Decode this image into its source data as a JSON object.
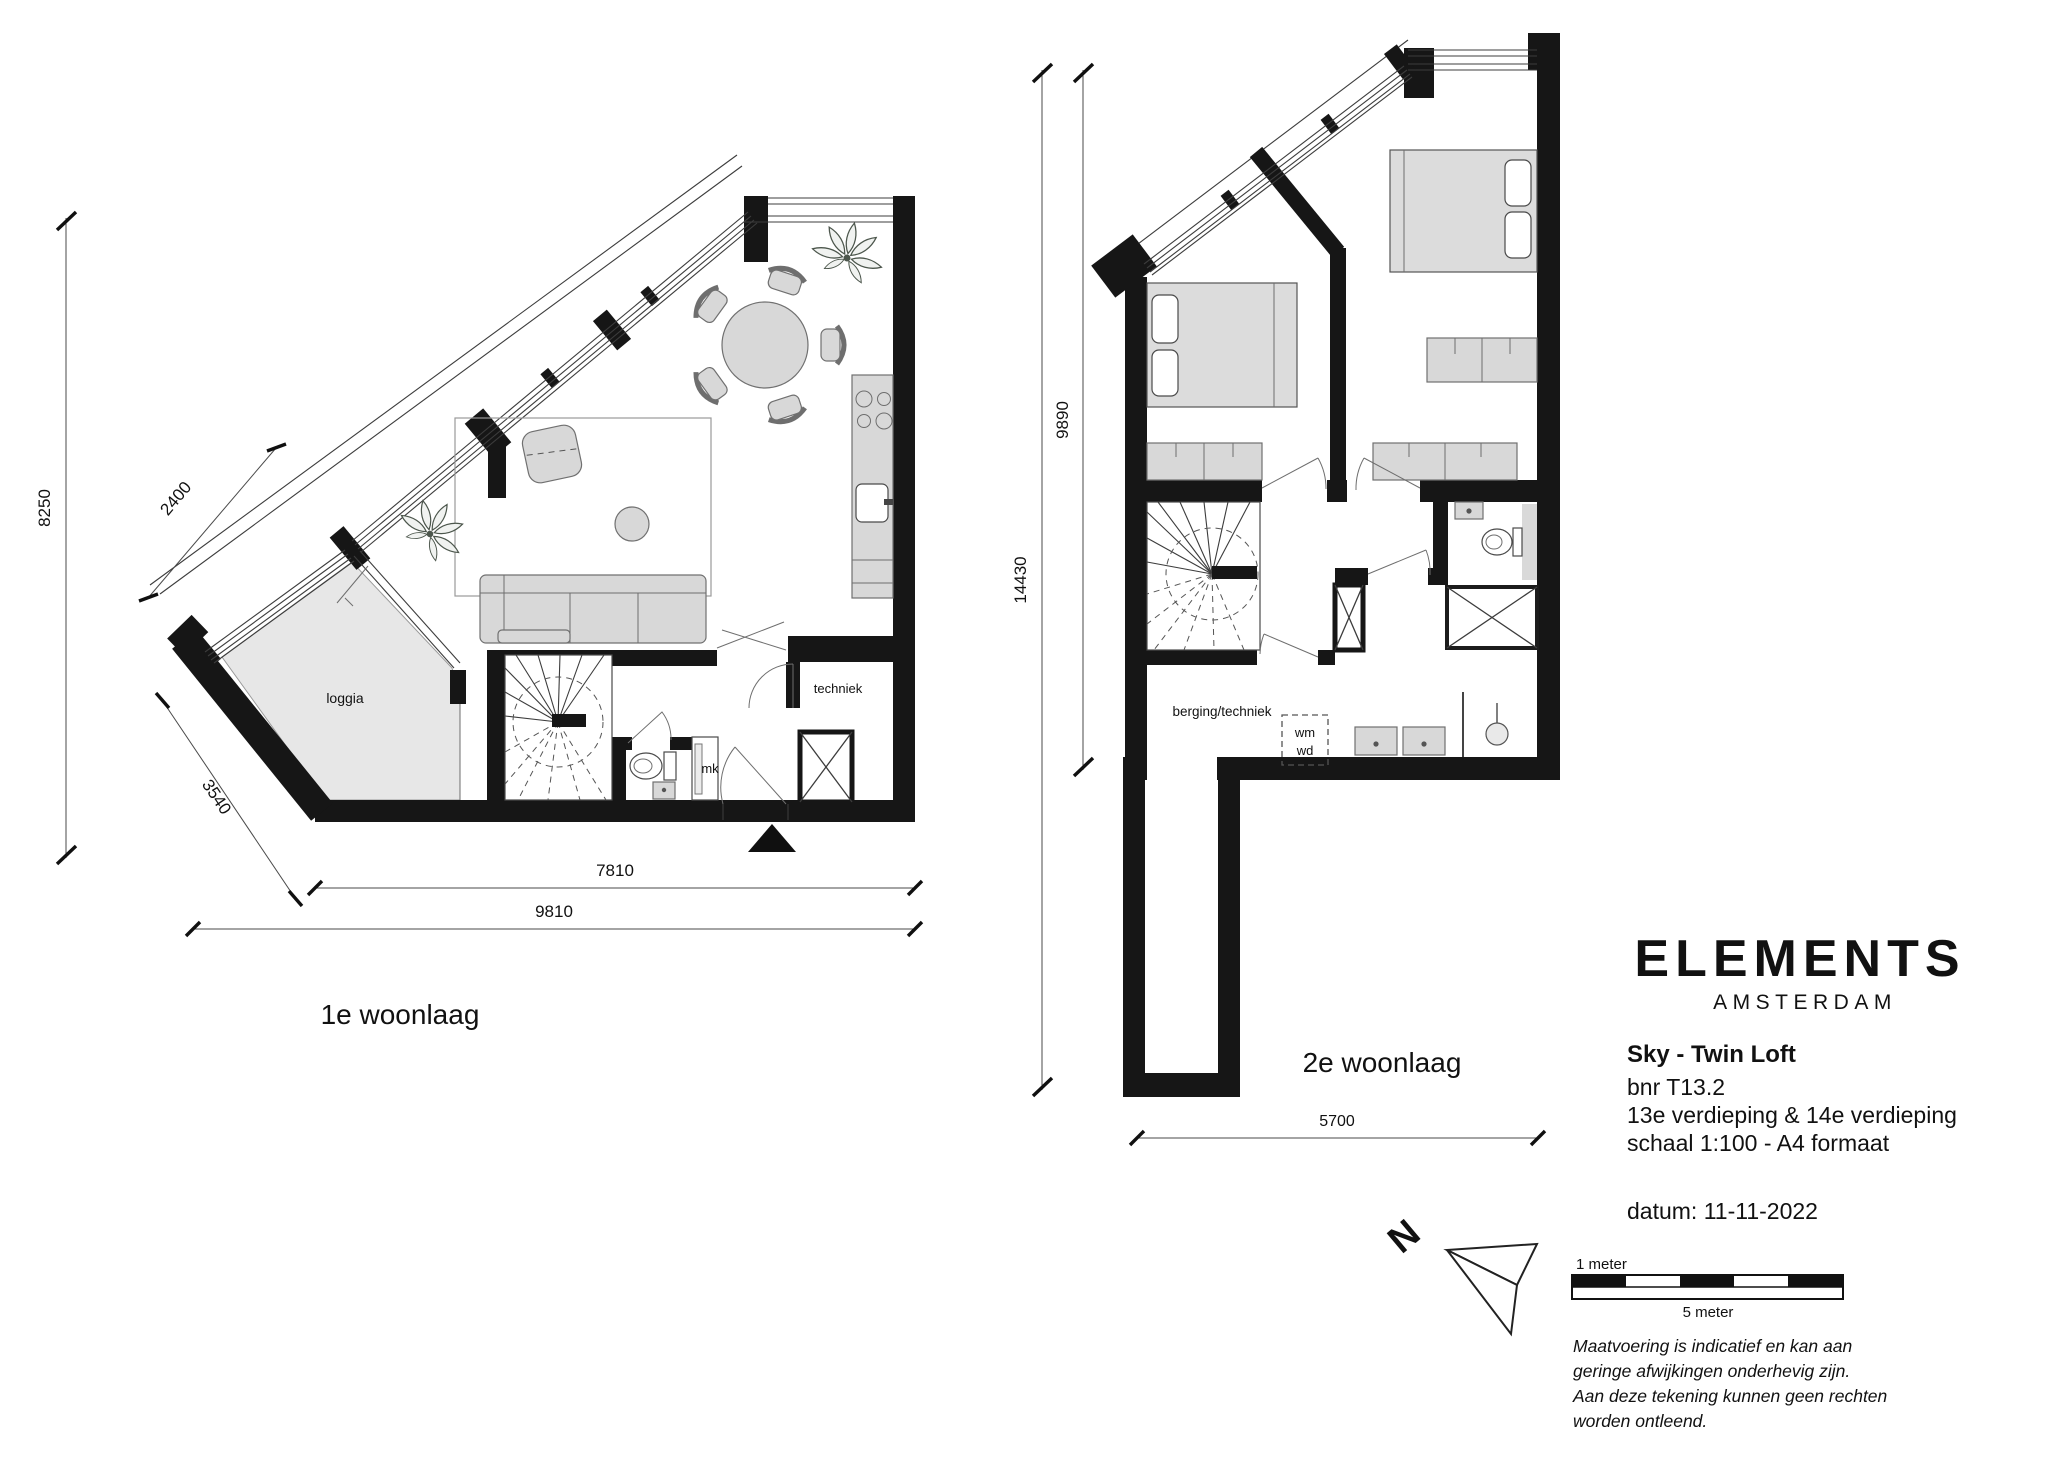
{
  "plan1": {
    "title": "1e woonlaag",
    "labels": {
      "loggia": "loggia",
      "techniek": "techniek",
      "mk": "mk"
    },
    "dims": {
      "left": "8250",
      "upper_diagonal": "2400",
      "lower_diagonal": "3540",
      "inner_width": "7810",
      "total_width": "9810"
    }
  },
  "plan2": {
    "title": "2e woonlaag",
    "labels": {
      "storage": "berging/techniek",
      "washer": "wm",
      "dryer": "wd"
    },
    "dims": {
      "upper_height": "9890",
      "total_height": "14430",
      "bottom_width": "5700"
    }
  },
  "title_block": {
    "brand": "ELEMENTS",
    "city": "AMSTERDAM",
    "unit": "Sky - Twin Loft",
    "bnr": "bnr T13.2",
    "floors": "13e verdieping & 14e verdieping",
    "scale": "schaal 1:100 - A4 formaat",
    "date": "datum: 11-11-2022"
  },
  "north": {
    "label": "N"
  },
  "scale_bar": {
    "unit_small": "1 meter",
    "unit_large": "5 meter"
  },
  "disclaimer": [
    "Maatvoering is indicatief en kan aan",
    "geringe afwijkingen onderhevig zijn.",
    "Aan deze tekening kunnen geen rechten",
    "worden ontleend."
  ]
}
